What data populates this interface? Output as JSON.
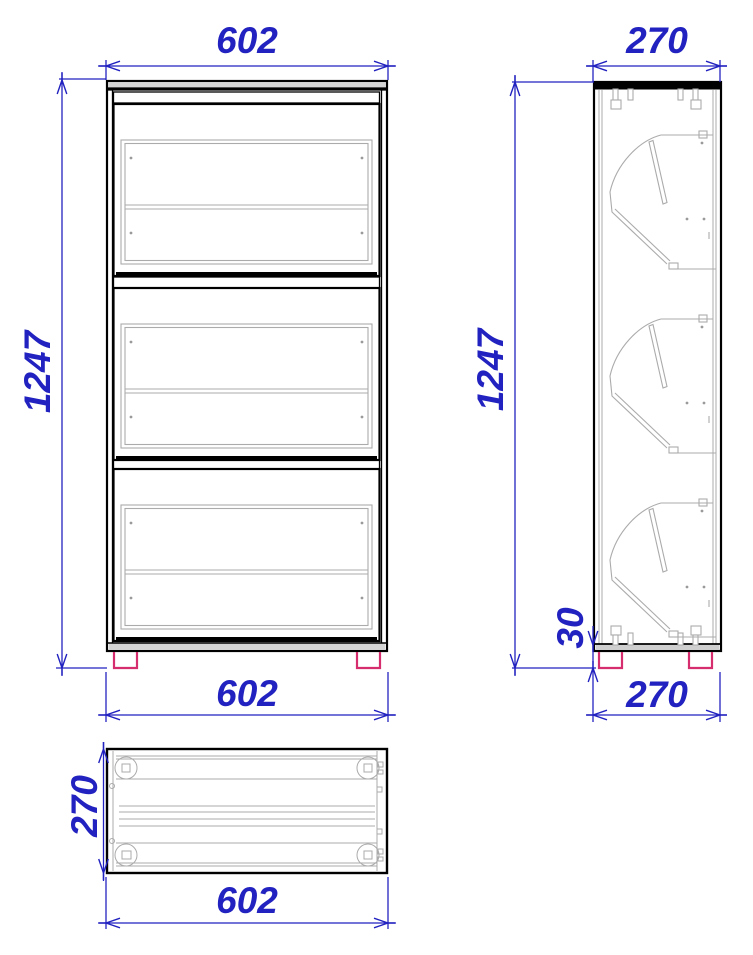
{
  "drawing": {
    "colors": {
      "dimension_blue": "#2222c0",
      "outline_black": "#000000",
      "detail_gray": "#ababab",
      "foot_pink": "#d62d6e",
      "background": "#ffffff"
    },
    "views": {
      "front": {
        "width_top": "602",
        "height": "1247",
        "width_bottom": "602"
      },
      "side": {
        "depth_top": "270",
        "height": "1247",
        "foot_height": "30",
        "depth_bottom": "270"
      },
      "top": {
        "depth": "270",
        "width": "602"
      }
    }
  }
}
